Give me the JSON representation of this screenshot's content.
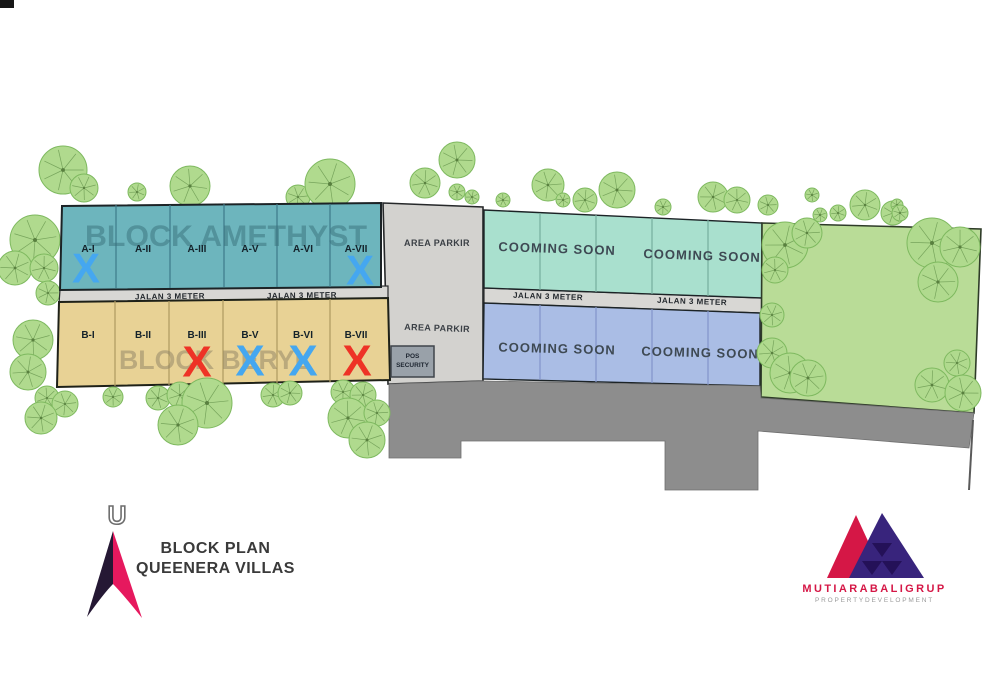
{
  "page": {
    "width": 991,
    "height": 700,
    "background": "#ffffff"
  },
  "plan": {
    "corner_mark": {
      "x": 0,
      "y": 0,
      "w": 14,
      "h": 8,
      "color": "#161616"
    },
    "tree_style": {
      "fill": "#b0da8e",
      "edge": "#7eb95f",
      "vein": "#6d9b53",
      "dot": "#59803f"
    },
    "trees_back": [
      [
        63,
        170,
        24
      ],
      [
        84,
        188,
        14
      ],
      [
        137,
        192,
        9
      ],
      [
        190,
        186,
        20
      ],
      [
        298,
        197,
        12
      ],
      [
        330,
        184,
        25
      ],
      [
        425,
        183,
        15
      ],
      [
        457,
        160,
        18
      ],
      [
        457,
        192,
        8
      ],
      [
        472,
        197,
        7
      ],
      [
        503,
        200,
        7
      ],
      [
        548,
        185,
        16
      ],
      [
        563,
        200,
        7
      ],
      [
        585,
        200,
        12
      ],
      [
        617,
        190,
        18
      ],
      [
        663,
        207,
        8
      ],
      [
        713,
        197,
        15
      ],
      [
        737,
        200,
        13
      ],
      [
        768,
        205,
        10
      ],
      [
        812,
        195,
        7
      ],
      [
        865,
        205,
        15
      ],
      [
        893,
        213,
        12
      ],
      [
        35,
        240,
        25
      ],
      [
        15,
        268,
        17
      ],
      [
        44,
        268,
        14
      ],
      [
        48,
        293,
        12
      ],
      [
        33,
        340,
        20
      ],
      [
        28,
        372,
        18
      ],
      [
        47,
        398,
        12
      ],
      [
        65,
        404,
        13
      ],
      [
        41,
        418,
        16
      ]
    ],
    "trees_front": [
      [
        785,
        245,
        23
      ],
      [
        775,
        270,
        13
      ],
      [
        807,
        233,
        15
      ],
      [
        820,
        215,
        7
      ],
      [
        838,
        213,
        8
      ],
      [
        897,
        205,
        6
      ],
      [
        900,
        213,
        8
      ],
      [
        932,
        243,
        25
      ],
      [
        960,
        247,
        20
      ],
      [
        938,
        282,
        20
      ],
      [
        772,
        315,
        12
      ],
      [
        772,
        353,
        15
      ],
      [
        790,
        373,
        20
      ],
      [
        808,
        378,
        18
      ],
      [
        957,
        363,
        13
      ],
      [
        932,
        385,
        17
      ],
      [
        963,
        393,
        18
      ],
      [
        113,
        397,
        10
      ],
      [
        158,
        398,
        12
      ],
      [
        180,
        395,
        13
      ],
      [
        207,
        403,
        25
      ],
      [
        178,
        425,
        20
      ],
      [
        273,
        395,
        12
      ],
      [
        290,
        393,
        12
      ],
      [
        343,
        392,
        12
      ],
      [
        363,
        395,
        13
      ],
      [
        348,
        418,
        20
      ],
      [
        377,
        413,
        13
      ],
      [
        367,
        440,
        18
      ]
    ],
    "areas": [
      {
        "id": "area-parkir",
        "fill": "#d3d2cf",
        "stroke": "#26282a",
        "sw": 1.6,
        "points": [
          [
            383,
            203
          ],
          [
            483,
            207
          ],
          [
            483,
            381
          ],
          [
            388,
            384
          ]
        ],
        "texts": [
          {
            "t": "AREA PARKIR",
            "x": 437,
            "y": 246,
            "fs": 9,
            "ls": 0.4,
            "fw": "bold",
            "fill": "#3b4046"
          },
          {
            "t": "AREA PARKIR",
            "x": 437,
            "y": 331,
            "fs": 9,
            "ls": 0.4,
            "fw": "bold",
            "fill": "#3b4046",
            "rot": 2
          }
        ]
      },
      {
        "id": "jalan-west",
        "fill": "#d8d7d4",
        "stroke": "#2b2d2f",
        "sw": 1.2,
        "points": [
          [
            60,
            290
          ],
          [
            388,
            286
          ],
          [
            388,
            301
          ],
          [
            59,
            304
          ]
        ],
        "texts": [
          {
            "t": "JALAN 3 METER",
            "x": 170,
            "y": 299,
            "fs": 8,
            "ls": 0.5,
            "fw": "bold",
            "fill": "#24292e",
            "rot": -0.8
          },
          {
            "t": "JALAN 3 METER",
            "x": 302,
            "y": 298,
            "fs": 8,
            "ls": 0.5,
            "fw": "bold",
            "fill": "#24292e",
            "rot": -0.8
          }
        ]
      },
      {
        "id": "jalan-east",
        "fill": "#d8d7d4",
        "stroke": "#2b2d2f",
        "sw": 1.2,
        "points": [
          [
            484,
            288
          ],
          [
            762,
            298
          ],
          [
            762,
            313
          ],
          [
            484,
            303
          ]
        ],
        "texts": [
          {
            "t": "JALAN 3 METER",
            "x": 548,
            "y": 299,
            "fs": 8,
            "ls": 0.5,
            "fw": "bold",
            "fill": "#24292e",
            "rot": 2
          },
          {
            "t": "JALAN 3 METER",
            "x": 692,
            "y": 304,
            "fs": 8,
            "ls": 0.5,
            "fw": "bold",
            "fill": "#24292e",
            "rot": 2
          }
        ]
      },
      {
        "id": "block-amethyst",
        "fill": "#6db5bd",
        "stroke": "#1c2326",
        "sw": 2,
        "points": [
          [
            62,
            206
          ],
          [
            381,
            203
          ],
          [
            381,
            287
          ],
          [
            60,
            290
          ]
        ],
        "divider_color": "#3e7a89",
        "dividers": [
          [
            116,
            205,
            288
          ],
          [
            170,
            205,
            288
          ],
          [
            224,
            204,
            287
          ],
          [
            277,
            204,
            287
          ],
          [
            330,
            204,
            287
          ]
        ],
        "watermark": {
          "t": "BLOCK AMETHYST",
          "x": 226,
          "y": 246,
          "fs": 30,
          "tl": 282,
          "fw": "bold",
          "fill": "#38707b",
          "op": 0.5
        },
        "lot_y": 252,
        "lot_fs": 10,
        "lot_color": "#14222a",
        "lots": [
          {
            "t": "A-I",
            "x": 88
          },
          {
            "t": "A-II",
            "x": 143
          },
          {
            "t": "A-III",
            "x": 197
          },
          {
            "t": "A-V",
            "x": 250
          },
          {
            "t": "A-VI",
            "x": 303
          },
          {
            "t": "A-VII",
            "x": 356
          }
        ],
        "mark_fs": 42,
        "marks": [
          {
            "t": "X",
            "x": 86,
            "y": 268,
            "color": "#45a7f0"
          },
          {
            "t": "X",
            "x": 360,
            "y": 270,
            "color": "#45a7f0"
          }
        ]
      },
      {
        "id": "cooming-soon-north",
        "fill": "#a9e0ce",
        "stroke": "#1c2326",
        "sw": 1.4,
        "points": [
          [
            484,
            210
          ],
          [
            762,
            223
          ],
          [
            762,
            298
          ],
          [
            484,
            288
          ]
        ],
        "divider_color": "#76ad9e",
        "dividers": [
          [
            540,
            213,
            290
          ],
          [
            596,
            215,
            292
          ],
          [
            652,
            218,
            294
          ],
          [
            708,
            220,
            296
          ]
        ],
        "texts": [
          {
            "t": "COOMING SOON",
            "x": 557,
            "y": 253,
            "fs": 13,
            "ls": 1,
            "fw": "bold",
            "fill": "#3e4953",
            "rot": 2
          },
          {
            "t": "COOMING SOON",
            "x": 702,
            "y": 260,
            "fs": 13,
            "ls": 1,
            "fw": "bold",
            "fill": "#3e4953",
            "rot": 2
          }
        ]
      },
      {
        "id": "block-beryl",
        "fill": "#e8d295",
        "stroke": "#1e2118",
        "sw": 2,
        "points": [
          [
            59,
            302
          ],
          [
            388,
            298
          ],
          [
            390,
            380
          ],
          [
            57,
            387
          ]
        ],
        "divider_color": "#ae9a60",
        "dividers": [
          [
            115,
            301,
            386
          ],
          [
            169,
            301,
            385
          ],
          [
            223,
            300,
            384
          ],
          [
            277,
            300,
            383
          ],
          [
            330,
            299,
            382
          ]
        ],
        "watermark": {
          "t": "BLOCK BERYL",
          "x": 215,
          "y": 369,
          "fs": 27,
          "tl": 192,
          "fw": "bold",
          "fill": "#8e8265",
          "op": 0.5
        },
        "lot_y": 338,
        "lot_fs": 10,
        "lot_color": "#14222a",
        "lots": [
          {
            "t": "B-I",
            "x": 88
          },
          {
            "t": "B-II",
            "x": 143
          },
          {
            "t": "B-III",
            "x": 197
          },
          {
            "t": "B-V",
            "x": 250
          },
          {
            "t": "B-VI",
            "x": 303
          },
          {
            "t": "B-VII",
            "x": 356
          }
        ],
        "mark_fs": 44,
        "marks": [
          {
            "t": "X",
            "x": 197,
            "y": 362,
            "color": "#ee3326"
          },
          {
            "t": "X",
            "x": 250,
            "y": 361,
            "color": "#45a7f0"
          },
          {
            "t": "X",
            "x": 303,
            "y": 361,
            "color": "#45a7f0"
          },
          {
            "t": "X",
            "x": 357,
            "y": 361,
            "color": "#ee3326"
          }
        ]
      },
      {
        "id": "cooming-soon-south",
        "fill": "#aabde5",
        "stroke": "#1c2326",
        "sw": 1.4,
        "points": [
          [
            484,
            303
          ],
          [
            760,
            313
          ],
          [
            760,
            386
          ],
          [
            483,
            379
          ]
        ],
        "divider_color": "#8294ca",
        "dividers": [
          [
            540,
            305,
            380
          ],
          [
            596,
            307,
            382
          ],
          [
            652,
            309,
            383
          ],
          [
            708,
            311,
            385
          ]
        ],
        "texts": [
          {
            "t": "COOMING SOON",
            "x": 557,
            "y": 353,
            "fs": 13,
            "ls": 1,
            "fw": "bold",
            "fill": "#3e4953",
            "rot": 1.5
          },
          {
            "t": "COOMING SOON",
            "x": 700,
            "y": 357,
            "fs": 13,
            "ls": 1,
            "fw": "bold",
            "fill": "#3e4953",
            "rot": 1.5
          }
        ]
      },
      {
        "id": "green-area",
        "fill": "#b9dc97",
        "stroke": "#2e3b28",
        "sw": 1.6,
        "points": [
          [
            762,
            223
          ],
          [
            981,
            229
          ],
          [
            974,
            413
          ],
          [
            761,
            397
          ]
        ]
      }
    ],
    "dark_road": {
      "fill": "#8d8d8d",
      "stroke": "#6f6f6f",
      "sw": 0.8,
      "points": [
        [
          389,
          384
        ],
        [
          483,
          381
        ],
        [
          760,
          386
        ],
        [
          761,
          398
        ],
        [
          974,
          413
        ],
        [
          969,
          448
        ],
        [
          758,
          431
        ],
        [
          758,
          490
        ],
        [
          665,
          490
        ],
        [
          665,
          441
        ],
        [
          461,
          441
        ],
        [
          461,
          458
        ],
        [
          389,
          458
        ]
      ]
    },
    "boundary_tail": {
      "x1": 973,
      "y1": 420,
      "x2": 969,
      "y2": 490,
      "color": "#5a5a5a",
      "sw": 2
    },
    "security": {
      "x": 391,
      "y": 346,
      "w": 43,
      "h": 31,
      "fill": "#99a1a9",
      "stroke": "#3f444b",
      "lines": [
        "POS",
        "SECURITY"
      ],
      "text_color": "#1d2530",
      "fs": 6.5
    }
  },
  "legend": {
    "north_label": "U",
    "title_line1": "BLOCK PLAN",
    "title_line2": "QUEENERA VILLAS",
    "arrow_dark": "#251834",
    "arrow_red": "#e6195e",
    "north_color": "#6e6e6e",
    "text_color": "#3a3a3a"
  },
  "developer": {
    "name": "MUTIARABALIGRUP",
    "tagline": "PROPERTYDEVELOPMENT",
    "brand_red": "#d51746",
    "brand_purple": "#38247c",
    "brand_purple_dark": "#241158",
    "tagline_color": "#9a9a9a"
  }
}
